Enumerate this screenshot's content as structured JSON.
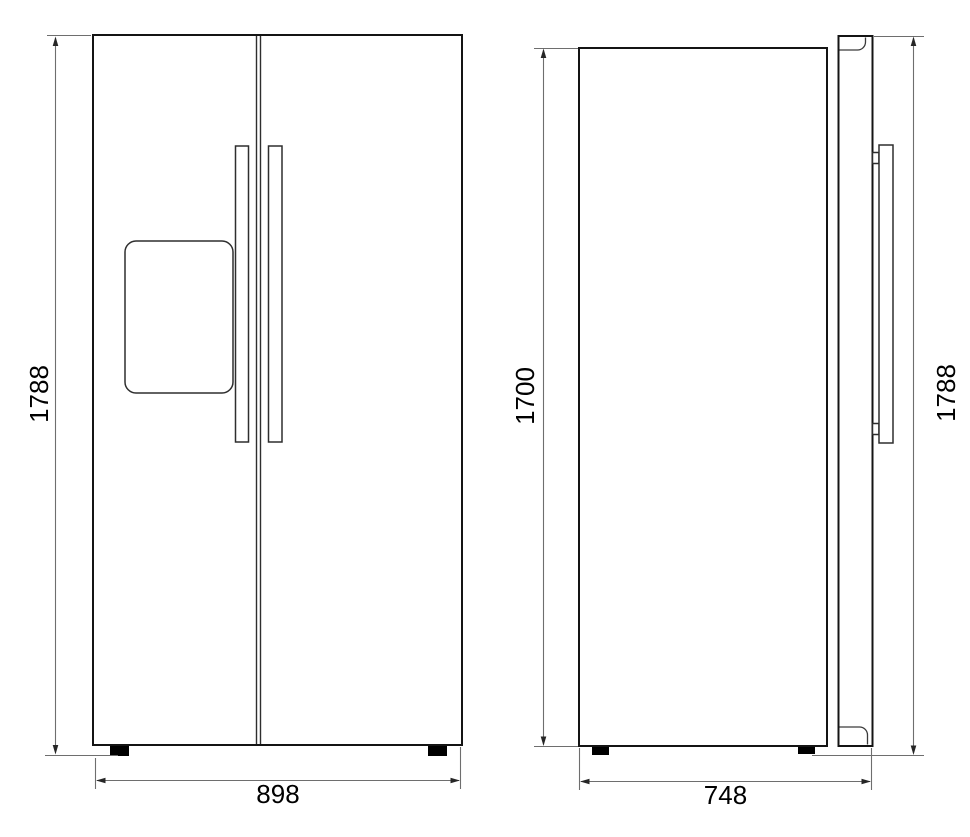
{
  "colors": {
    "background": "#ffffff",
    "object_outline": "#141414",
    "dimension_lines": "#6e6e6e",
    "arrowheads": "#262626",
    "dimension_text": "#000000",
    "feet": "#000000"
  },
  "dimensions": {
    "front_overall_height": "1788",
    "front_overall_width": "898",
    "side_body_height": "1700",
    "side_depth": "748",
    "side_overall_height": "1788"
  }
}
